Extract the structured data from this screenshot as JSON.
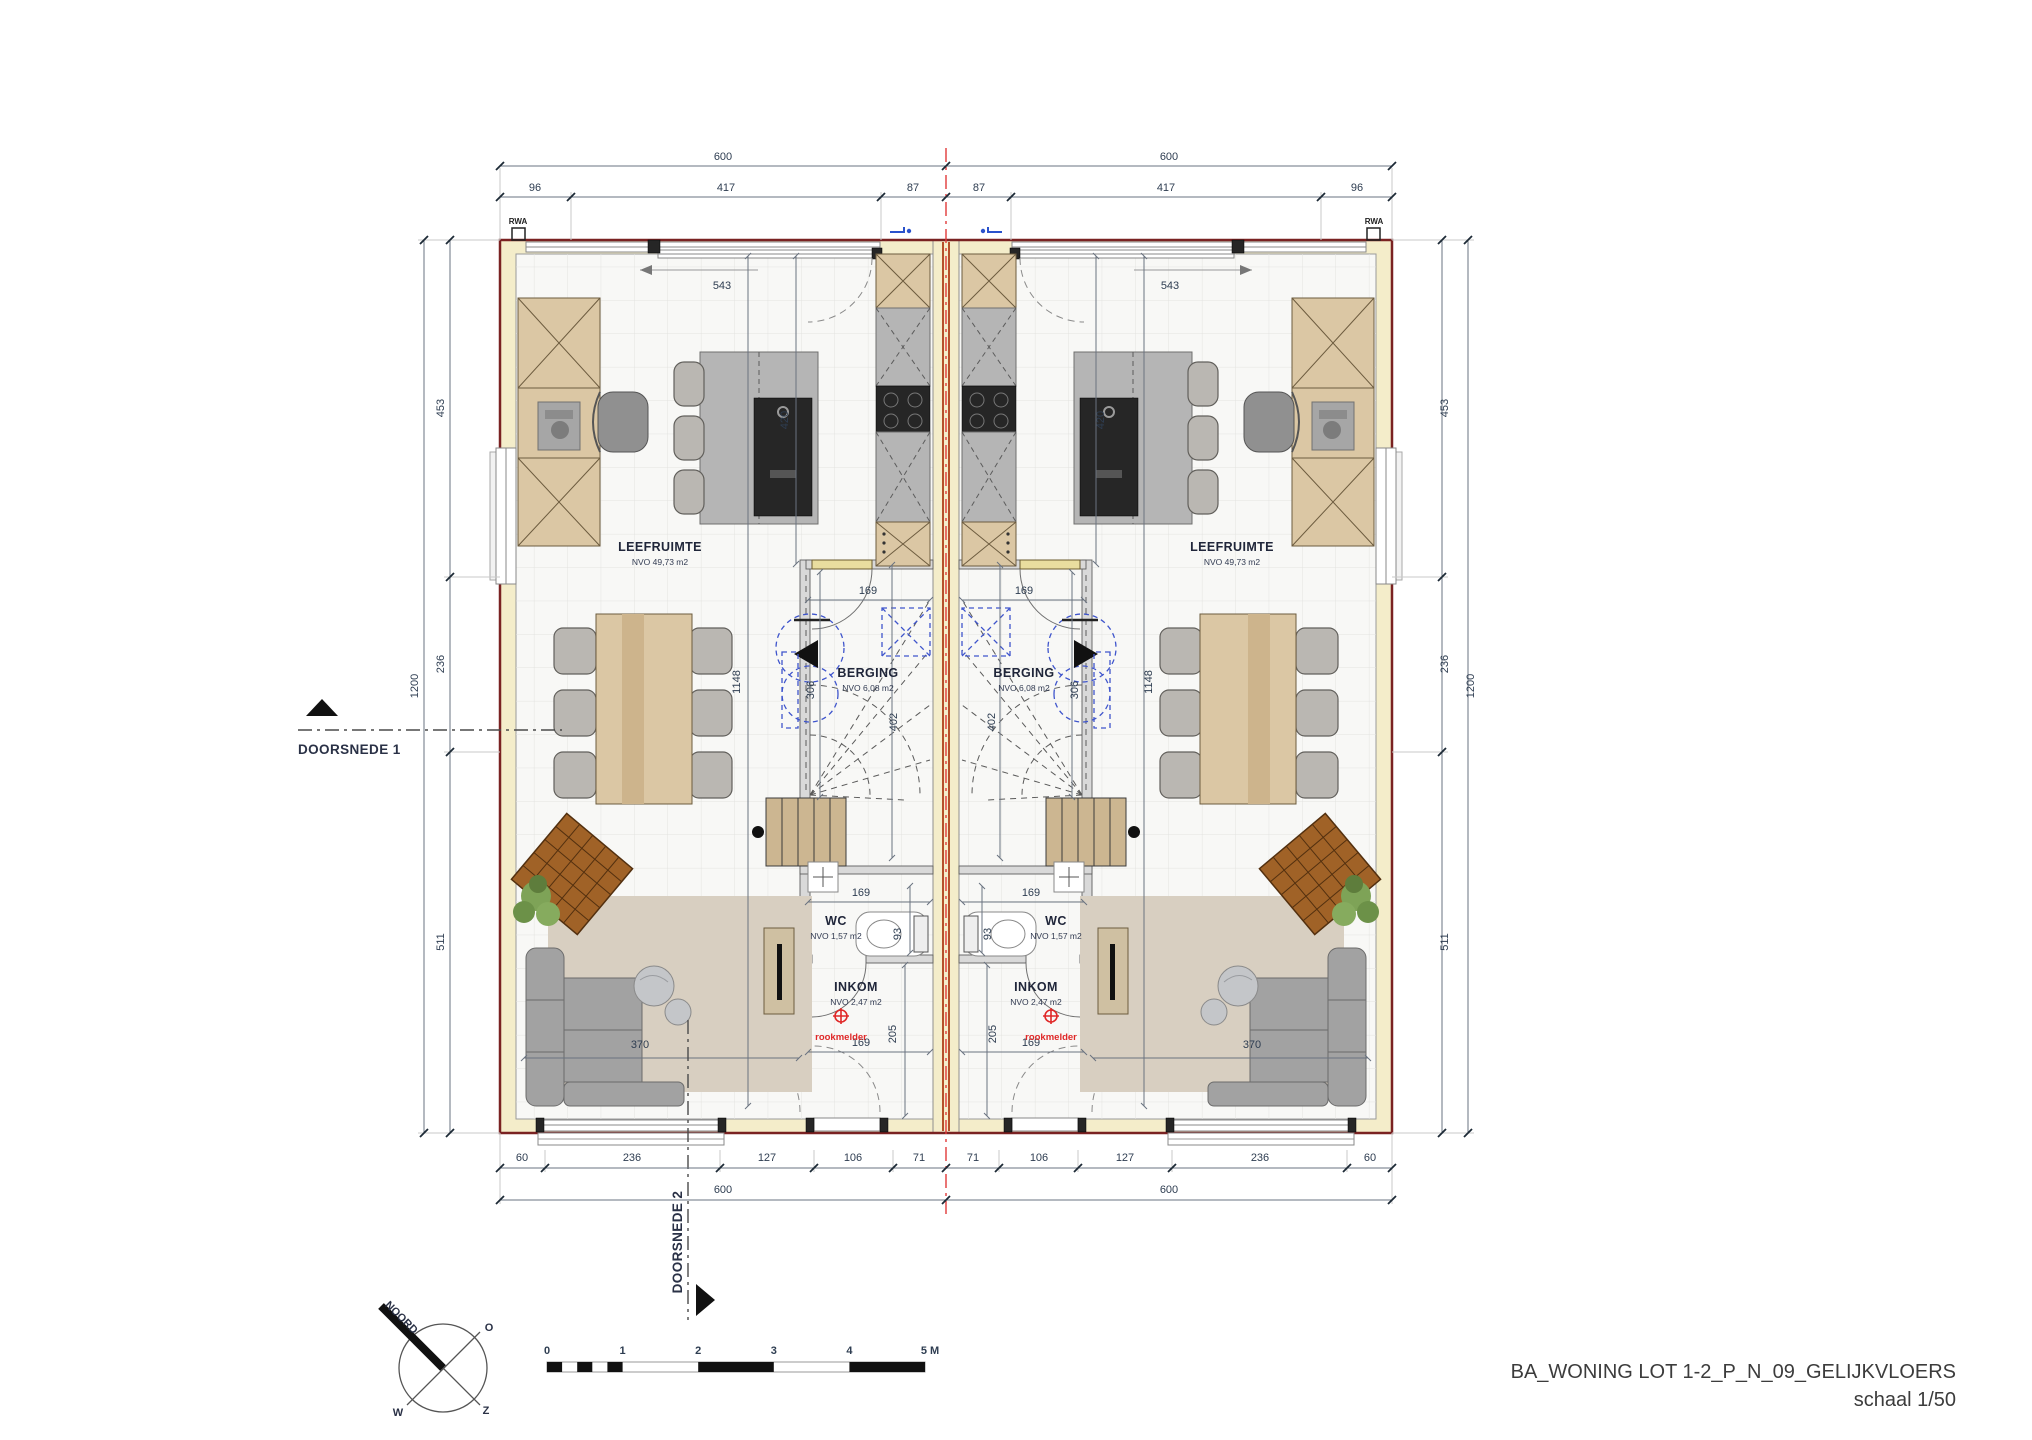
{
  "title_block": {
    "line1": "BA_WONING LOT 1-2_P_N_09_GELIJKVLOERS",
    "line2": "schaal 1/50"
  },
  "sections": {
    "s1": "DOORSNEDE 1",
    "s2": "DOORSNEDE 2"
  },
  "compass": {
    "north": "NOORD",
    "o": "O",
    "z": "Z",
    "w": "W"
  },
  "scalebar": {
    "t0": "0",
    "t1": "1",
    "t2": "2",
    "t3": "3",
    "t4": "4",
    "t5": "5 M"
  },
  "annotations": {
    "rwa": "RWA",
    "rookmelder": "rookmelder"
  },
  "rooms": {
    "leefruimte": {
      "name": "LEEFRUIMTE",
      "area": "NVO 49,73 m2"
    },
    "berging": {
      "name": "BERGING",
      "area": "NVO 6,08 m2"
    },
    "wc": {
      "name": "WC",
      "area": "NVO 1,57 m2"
    },
    "inkom": {
      "name": "INKOM",
      "area": "NVO 2,47 m2"
    }
  },
  "dims": {
    "top": {
      "overall": "600",
      "a": "96",
      "b": "417",
      "c": "87"
    },
    "side": {
      "overall": "1200",
      "a": "453",
      "b": "236",
      "c": "511"
    },
    "bottom": {
      "overall": "600",
      "a": "60",
      "b": "236",
      "c": "127",
      "d": "106",
      "e": "71"
    },
    "interior": {
      "sliding": "543",
      "kitchen_depth": "420",
      "berging_width": "169",
      "strip_length": "1148",
      "berging_depth": "306",
      "stair": "402",
      "wc_width": "169",
      "wc_depth": "93",
      "inkom_height": "205",
      "inkom_width": "169",
      "sofa": "370"
    }
  },
  "colors": {
    "wall_fill": "#f4edca",
    "brick_edge": "#7a2222",
    "party_core": "#b5502a",
    "centerline_red": "#e03a3a",
    "annotation_red": "#e02828",
    "blue_dashed": "#3f55cc"
  }
}
